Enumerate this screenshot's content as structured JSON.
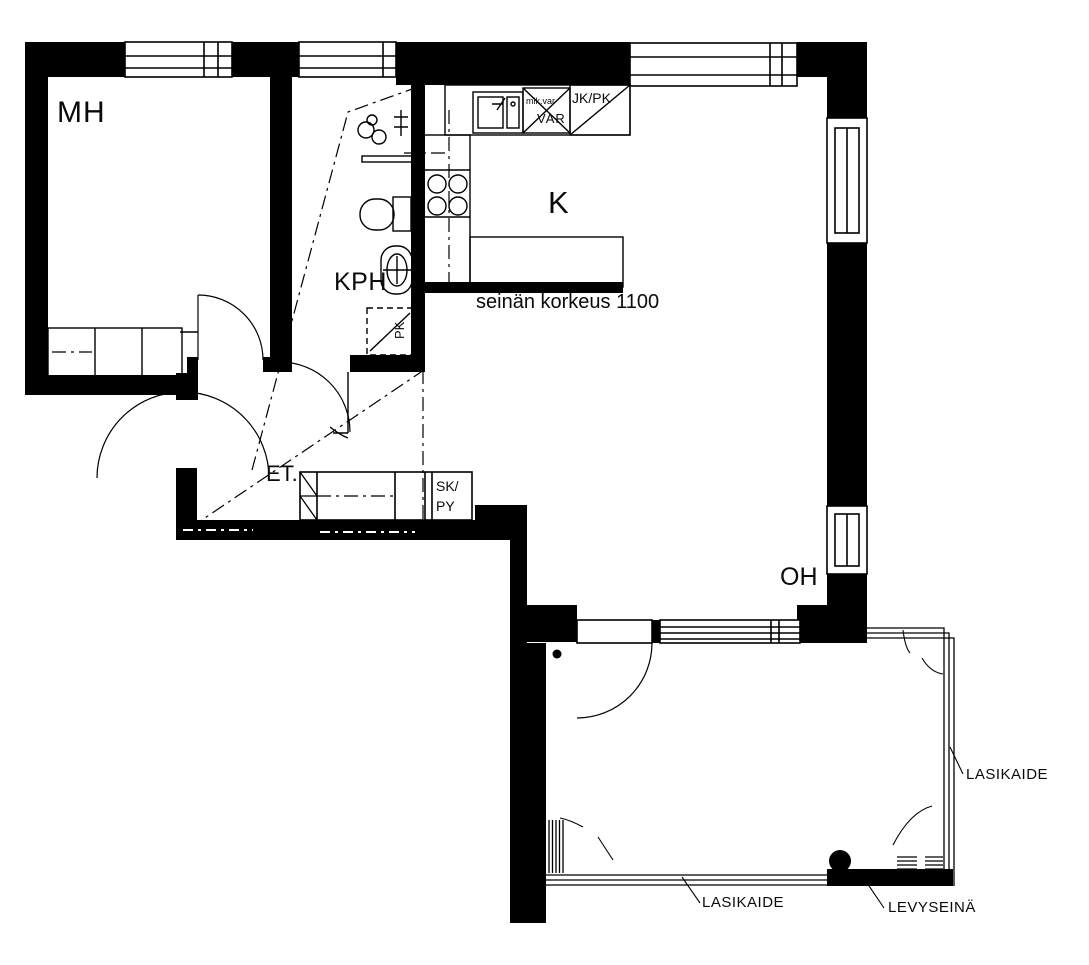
{
  "title": "apartment floor plan",
  "colors": {
    "line": "#000000",
    "background": "#ffffff"
  },
  "rooms": {
    "bedroom": "MH",
    "bathroom": "KPH",
    "kitchen": "K",
    "hallway": "ET.",
    "living_room": "OH"
  },
  "kitchen_labels": {
    "fridge_freezer": "JK/PK",
    "micro_reservation": "mik.var",
    "reservation": "VAR"
  },
  "bathroom_labels": {
    "washer_reservation": "PK"
  },
  "hallway_labels": {
    "closets": "SK/\nPY"
  },
  "annotations": {
    "wall_height": "seinän korkeus 1100",
    "glass_railing_right": "LASIKAIDE",
    "glass_railing_bottom": "LASIKAIDE",
    "panel_wall": "LEVYSEINÄ"
  }
}
